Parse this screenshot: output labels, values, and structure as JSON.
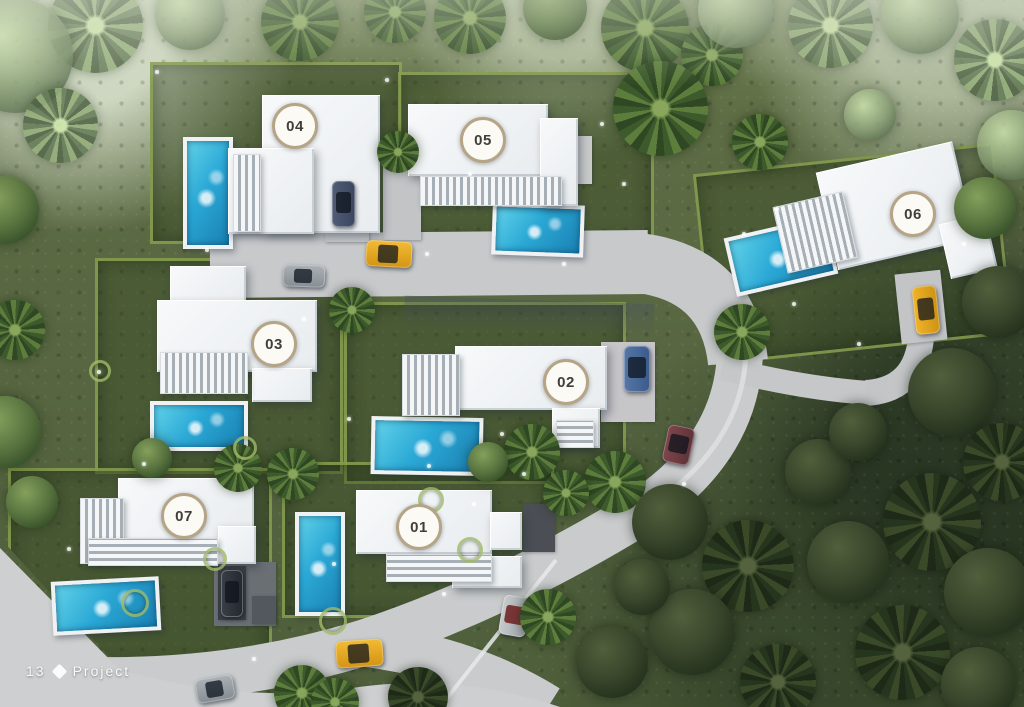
{
  "villas": [
    {
      "id": "villa-01",
      "number": "01"
    },
    {
      "id": "villa-02",
      "number": "02"
    },
    {
      "id": "villa-03",
      "number": "03"
    },
    {
      "id": "villa-04",
      "number": "04"
    },
    {
      "id": "villa-05",
      "number": "05"
    },
    {
      "id": "villa-06",
      "number": "06"
    },
    {
      "id": "villa-07",
      "number": "07"
    }
  ],
  "footer": {
    "page": "13",
    "label": "Project"
  },
  "colors": {
    "grass": "#566540",
    "road": "#c7c9cb",
    "building": "#f2f4f6",
    "pool_water": "#2ba9d6",
    "pool_deck": "#eff1f2",
    "badge_ring": "#b5a486",
    "badge_text": "#403f3b",
    "hedge": "#88a050",
    "car_gold": "#e6a41e"
  }
}
